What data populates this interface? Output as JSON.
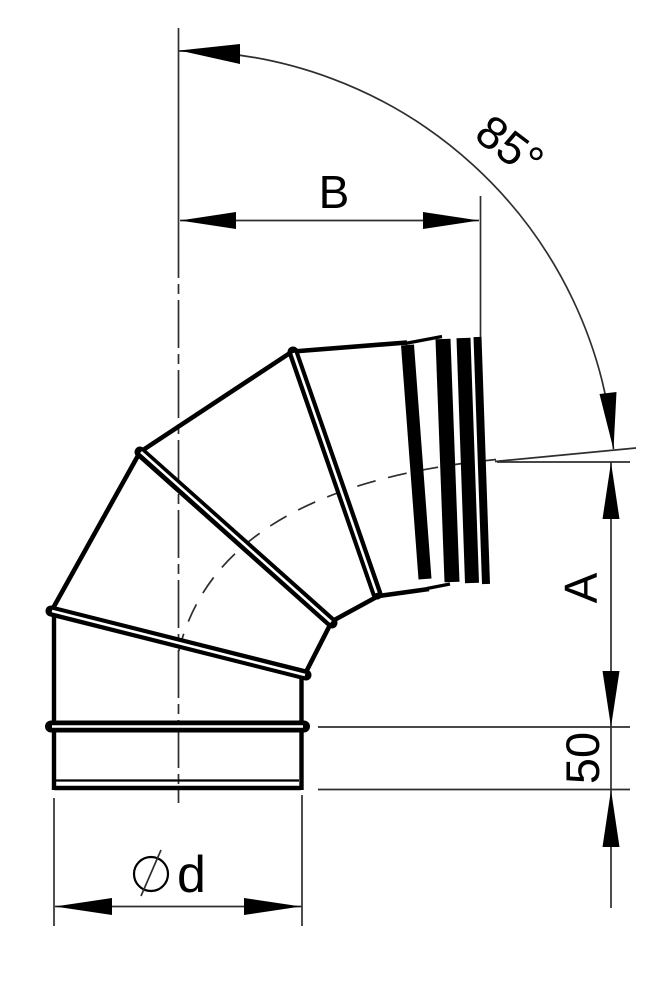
{
  "drawing": {
    "description": "Technical dimension drawing of a segmented 85-degree pipe elbow",
    "angle_value": "85°"
  },
  "labels": {
    "angle": "85°",
    "width": "B",
    "height": "A",
    "socket_length": "50",
    "diameter": "d"
  },
  "symbols": {
    "diameter_symbol_glyph": "⌀"
  },
  "colors": {
    "ink": "#000000",
    "thin_line": "#2e2e2e",
    "background": "#ffffff"
  }
}
